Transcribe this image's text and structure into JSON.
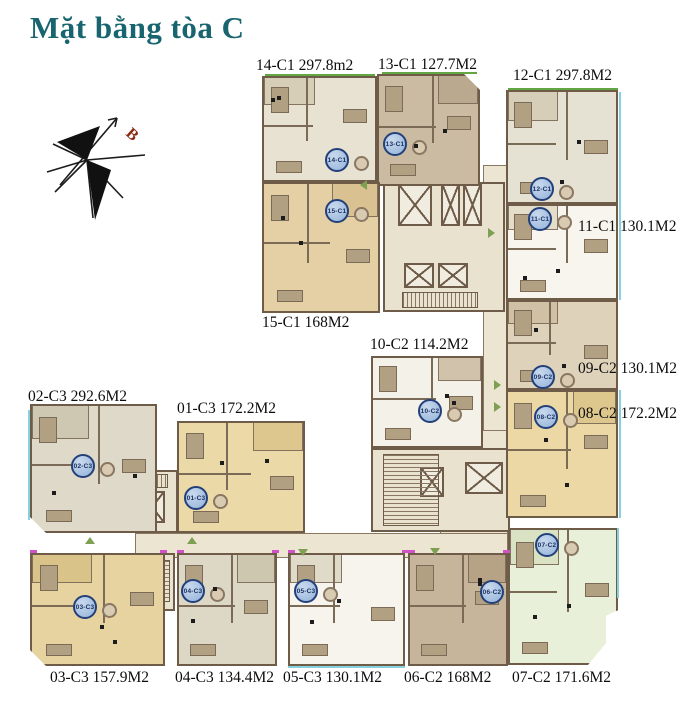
{
  "title": "Mặt bằng tòa C",
  "compass": {
    "label": "B",
    "label_color": "#8a2a12"
  },
  "colors": {
    "title": "#186570",
    "wall": "#6e5c49",
    "corridor": "#ece5d2",
    "badge_fill": "#a9c2e2",
    "badge_border": "#23407a",
    "cyan_edge": "#85d2de",
    "green_edge": "#63a743",
    "arrow_green": "#7f9f52",
    "magenta_tick": "#cf52c7"
  },
  "floorplan": {
    "units": [
      {
        "id": "14-C1",
        "area": "297.8m2",
        "label": "14-C1 297.8m2",
        "fill": "#e7e2d2",
        "accent": "#d6cdb6",
        "rect": [
          262,
          76,
          115,
          106
        ],
        "badge": [
          337,
          160
        ],
        "label_pos": [
          256,
          57
        ],
        "chamfer": ""
      },
      {
        "id": "13-C1",
        "area": "127.7M2",
        "label": "13-C1 127.7M2",
        "fill": "#cabba2",
        "accent": "#b9a88c",
        "rect": [
          377,
          74,
          103,
          112
        ],
        "badge": [
          395,
          144
        ],
        "label_pos": [
          378,
          56
        ],
        "chamfer": "tr"
      },
      {
        "id": "12-C1",
        "area": "297.8M2",
        "label": "12-C1 297.8M2",
        "fill": "#e6e2d3",
        "accent": "#d6cdb8",
        "rect": [
          506,
          90,
          112,
          114
        ],
        "badge": [
          542,
          189
        ],
        "label_pos": [
          513,
          67
        ],
        "chamfer": ""
      },
      {
        "id": "15-C1",
        "area": "168M2",
        "label": "15-C1 168M2",
        "fill": "#e5d0a6",
        "accent": "#d8c090",
        "rect": [
          262,
          182,
          118,
          131
        ],
        "badge": [
          337,
          211
        ],
        "label_pos": [
          262,
          314
        ],
        "chamfer": ""
      },
      {
        "id": "11-C1",
        "area": "130.1M2",
        "label": "11-C1 130.1M2",
        "fill": "#f7f5ee",
        "accent": "#e3dbc8",
        "rect": [
          506,
          204,
          112,
          96
        ],
        "badge": [
          540,
          219
        ],
        "label_pos": [
          578,
          218
        ],
        "chamfer": ""
      },
      {
        "id": "10-C2",
        "area": "114.2M2",
        "label": "10-C2 114.2M2",
        "fill": "#f4f1e9",
        "accent": "#cfc0a6",
        "rect": [
          371,
          356,
          112,
          92
        ],
        "badge": [
          430,
          411
        ],
        "label_pos": [
          370,
          336
        ],
        "chamfer": ""
      },
      {
        "id": "09-C2",
        "area": "130.1M2",
        "label": "09-C2 130.1M2",
        "fill": "#ded2ba",
        "accent": "#cfc0a4",
        "rect": [
          506,
          300,
          112,
          90
        ],
        "badge": [
          543,
          377
        ],
        "label_pos": [
          578,
          360
        ],
        "chamfer": ""
      },
      {
        "id": "08-C2",
        "area": "172.2M2",
        "label": "08-C2 172.2M2",
        "fill": "#ebd8a4",
        "accent": "#ddc68a",
        "rect": [
          506,
          390,
          112,
          128
        ],
        "badge": [
          546,
          417
        ],
        "label_pos": [
          578,
          405
        ],
        "chamfer": ""
      },
      {
        "id": "02-C3",
        "area": "292.6M2",
        "label": "02-C3 292.6M2",
        "fill": "#ded9c8",
        "accent": "#cdc6b0",
        "rect": [
          30,
          404,
          127,
          129
        ],
        "badge": [
          83,
          466
        ],
        "label_pos": [
          28,
          388
        ],
        "chamfer": "bl"
      },
      {
        "id": "01-C3",
        "area": "172.2M2",
        "label": "01-C3 172.2M2",
        "fill": "#ebd9a7",
        "accent": "#ddc68c",
        "rect": [
          177,
          421,
          128,
          112
        ],
        "badge": [
          196,
          498
        ],
        "label_pos": [
          177,
          400
        ],
        "chamfer": ""
      },
      {
        "id": "03-C3",
        "area": "157.9M2",
        "label": "03-C3 157.9M2",
        "fill": "#e7d39f",
        "accent": "#d9c287",
        "rect": [
          30,
          553,
          135,
          113
        ],
        "badge": [
          85,
          607
        ],
        "label_pos": [
          50,
          669
        ],
        "chamfer": "bl"
      },
      {
        "id": "04-C3",
        "area": "134.4M2",
        "label": "04-C3 134.4M2",
        "fill": "#dcd8c5",
        "accent": "#ccc6ae",
        "rect": [
          177,
          553,
          100,
          113
        ],
        "badge": [
          193,
          591
        ],
        "label_pos": [
          175,
          669
        ],
        "chamfer": ""
      },
      {
        "id": "05-C3",
        "area": "130.1M2",
        "label": "05-C3 130.1M2",
        "fill": "#f6f4ed",
        "accent": "#dfd9c6",
        "rect": [
          288,
          553,
          117,
          113
        ],
        "badge": [
          306,
          591
        ],
        "label_pos": [
          283,
          669
        ],
        "chamfer": ""
      },
      {
        "id": "06-C2",
        "area": "168M2",
        "label": "06-C2 168M2",
        "fill": "#c6b59a",
        "accent": "#b5a284",
        "rect": [
          408,
          553,
          100,
          113
        ],
        "badge": [
          492,
          592
        ],
        "label_pos": [
          404,
          669
        ],
        "chamfer": ""
      },
      {
        "id": "07-C2",
        "area": "171.6M2",
        "label": "07-C2 171.6M2",
        "fill": "#e9f0da",
        "accent": "#d8e2c2",
        "rect": [
          508,
          528,
          110,
          137
        ],
        "badge": [
          547,
          545
        ],
        "label_pos": [
          512,
          669
        ],
        "chamfer": "br"
      }
    ],
    "corridors": [
      [
        483,
        165,
        25,
        393
      ],
      [
        440,
        430,
        68,
        127
      ],
      [
        135,
        533,
        373,
        25
      ]
    ],
    "cores": [
      [
        383,
        182,
        122,
        130
      ],
      [
        371,
        448,
        139,
        84
      ],
      [
        100,
        470,
        78,
        63
      ],
      [
        97,
        553,
        78,
        58
      ]
    ],
    "elevators": [
      [
        398,
        184,
        34,
        42
      ],
      [
        441,
        184,
        19,
        42
      ],
      [
        463,
        184,
        19,
        42
      ],
      [
        404,
        263,
        30,
        25
      ],
      [
        438,
        263,
        30,
        25
      ],
      [
        465,
        462,
        38,
        32
      ],
      [
        420,
        467,
        24,
        30
      ],
      [
        108,
        491,
        26,
        32
      ],
      [
        139,
        491,
        26,
        32
      ],
      [
        106,
        560,
        32,
        36
      ]
    ],
    "stairs": [
      [
        402,
        292,
        76,
        16,
        "h"
      ],
      [
        383,
        454,
        56,
        72,
        "v"
      ],
      [
        142,
        560,
        28,
        42,
        "v"
      ],
      [
        108,
        474,
        60,
        14,
        "h"
      ]
    ],
    "edges_cyan": [
      [
        619,
        92,
        2,
        208
      ],
      [
        619,
        390,
        2,
        128
      ],
      [
        617,
        528,
        2,
        70
      ],
      [
        28,
        410,
        2,
        110
      ],
      [
        288,
        666,
        117,
        2
      ]
    ],
    "edges_green": [
      [
        265,
        74,
        110,
        2
      ],
      [
        382,
        72,
        95,
        2
      ],
      [
        508,
        88,
        110,
        2
      ]
    ],
    "ticks": [
      [
        30,
        550
      ],
      [
        160,
        550
      ],
      [
        177,
        550
      ],
      [
        272,
        550
      ],
      [
        288,
        550
      ],
      [
        402,
        550
      ],
      [
        408,
        550
      ],
      [
        503,
        550
      ]
    ],
    "arrows": [
      {
        "x": 85,
        "y": 537,
        "dir": "up"
      },
      {
        "x": 187,
        "y": 537,
        "dir": "up"
      },
      {
        "x": 298,
        "y": 549,
        "dir": "down"
      },
      {
        "x": 430,
        "y": 548,
        "dir": "down"
      },
      {
        "x": 494,
        "y": 380,
        "dir": "right"
      },
      {
        "x": 494,
        "y": 402,
        "dir": "right"
      },
      {
        "x": 360,
        "y": 180,
        "dir": "left"
      },
      {
        "x": 488,
        "y": 228,
        "dir": "right"
      }
    ]
  }
}
